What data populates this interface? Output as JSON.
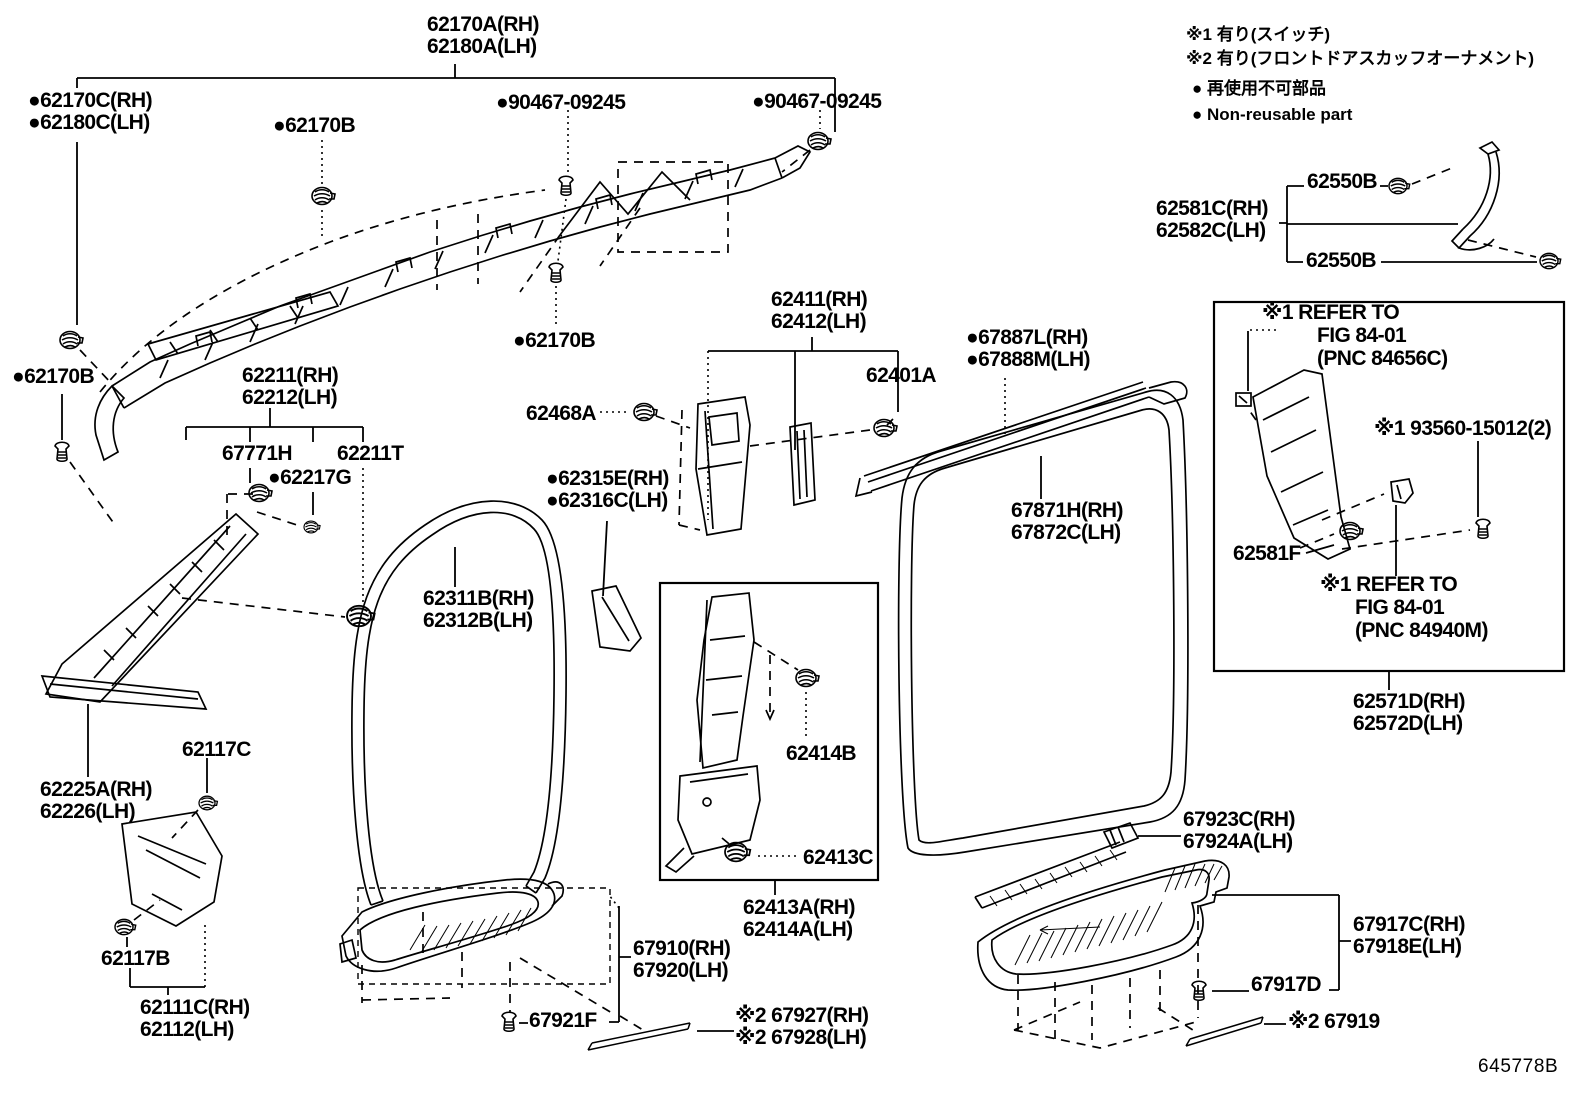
{
  "page": {
    "title": "Toyota interior trim parts diagram - inside trim board, pillar garnish and scuff plates",
    "drawing_number": "645778B",
    "background": "#ffffff",
    "line_color": "#000000"
  },
  "legend": {
    "note1": "※1 有り(スイッチ)",
    "note2": "※2 有り(フロントドアスカッフオーナメント)",
    "note3": "● 再使用不可部品",
    "note4": "● Non-reusable part"
  },
  "labels": [
    {
      "id": "62170a",
      "kind": "part",
      "x": 427,
      "y": 14,
      "text": "62170A(RH)\n62180A(LH)"
    },
    {
      "id": "62170c",
      "kind": "part",
      "x": 28,
      "y": 90,
      "text": "●62170C(RH)\n●62180C(LH)"
    },
    {
      "id": "62170b-top",
      "kind": "part",
      "x": 273,
      "y": 115,
      "text": "●62170B"
    },
    {
      "id": "90467-left",
      "kind": "part",
      "x": 496,
      "y": 92,
      "text": "●90467-09245"
    },
    {
      "id": "90467-right",
      "kind": "part",
      "x": 752,
      "y": 91,
      "text": "●90467-09245"
    },
    {
      "id": "note-switch",
      "kind": "note",
      "x": 1186,
      "y": 22,
      "text": "※1 有り(スイッチ)"
    },
    {
      "id": "note-scuff",
      "kind": "note",
      "x": 1186,
      "y": 46,
      "text": "※2 有り(フロントドアスカッフオーナメント)"
    },
    {
      "id": "note-jp",
      "kind": "note",
      "x": 1192,
      "y": 76,
      "text": "● 再使用不可部品"
    },
    {
      "id": "note-en",
      "kind": "note",
      "x": 1192,
      "y": 102,
      "text": "● Non-reusable part"
    },
    {
      "id": "62550b-top",
      "kind": "part",
      "x": 1307,
      "y": 171,
      "text": "62550B"
    },
    {
      "id": "62581c",
      "kind": "part",
      "x": 1156,
      "y": 198,
      "text": "62581C(RH)\n62582C(LH)"
    },
    {
      "id": "62550b-bottom",
      "kind": "part",
      "x": 1306,
      "y": 250,
      "text": "62550B"
    },
    {
      "id": "62170b-left",
      "kind": "part",
      "x": 12,
      "y": 366,
      "text": "●62170B"
    },
    {
      "id": "62211",
      "kind": "part",
      "x": 242,
      "y": 365,
      "text": "62211(RH)\n62212(LH)"
    },
    {
      "id": "67771h",
      "kind": "part",
      "x": 222,
      "y": 443,
      "text": "67771H"
    },
    {
      "id": "62211t",
      "kind": "part",
      "x": 337,
      "y": 443,
      "text": "62211T"
    },
    {
      "id": "62217g",
      "kind": "part",
      "x": 268,
      "y": 467,
      "text": "●62217G"
    },
    {
      "id": "62468a",
      "kind": "part",
      "x": 526,
      "y": 403,
      "text": "62468A"
    },
    {
      "id": "62411",
      "kind": "part",
      "x": 771,
      "y": 289,
      "text": "62411(RH)\n62412(LH)"
    },
    {
      "id": "62401a",
      "kind": "part",
      "x": 866,
      "y": 365,
      "text": "62401A"
    },
    {
      "id": "62170b-mid",
      "kind": "part",
      "x": 513,
      "y": 330,
      "text": "●62170B"
    },
    {
      "id": "67887l",
      "kind": "part",
      "x": 966,
      "y": 327,
      "text": "●67887L(RH)\n●67888M(LH)"
    },
    {
      "id": "62315e",
      "kind": "part",
      "x": 546,
      "y": 468,
      "text": "●62315E(RH)\n●62316C(LH)"
    },
    {
      "id": "67871h",
      "kind": "part",
      "x": 1011,
      "y": 500,
      "text": "67871H(RH)\n67872C(LH)"
    },
    {
      "id": "62311b",
      "kind": "part",
      "x": 423,
      "y": 588,
      "text": "62311B(RH)\n62312B(LH)"
    },
    {
      "id": "refer1-1",
      "kind": "part",
      "x": 1262,
      "y": 302,
      "text": "※1 REFER TO"
    },
    {
      "id": "refer1-2",
      "kind": "part",
      "x": 1317,
      "y": 325,
      "text": "FIG 84-01"
    },
    {
      "id": "refer1-3",
      "kind": "part",
      "x": 1317,
      "y": 348,
      "text": "(PNC 84656C)"
    },
    {
      "id": "93560",
      "kind": "part",
      "x": 1374,
      "y": 418,
      "text": "※1 93560-15012(2)"
    },
    {
      "id": "62581f",
      "kind": "part",
      "x": 1233,
      "y": 543,
      "text": "62581F"
    },
    {
      "id": "refer2-1",
      "kind": "part",
      "x": 1320,
      "y": 574,
      "text": "※1 REFER TO"
    },
    {
      "id": "refer2-2",
      "kind": "part",
      "x": 1355,
      "y": 597,
      "text": "FIG 84-01"
    },
    {
      "id": "refer2-3",
      "kind": "part",
      "x": 1355,
      "y": 620,
      "text": "(PNC 84940M)"
    },
    {
      "id": "62571d",
      "kind": "part",
      "x": 1353,
      "y": 691,
      "text": "62571D(RH)\n62572D(LH)"
    },
    {
      "id": "62117c",
      "kind": "part",
      "x": 182,
      "y": 739,
      "text": "62117C"
    },
    {
      "id": "62225a",
      "kind": "part",
      "x": 40,
      "y": 779,
      "text": "62225A(RH)\n62226(LH)"
    },
    {
      "id": "62414b",
      "kind": "part",
      "x": 786,
      "y": 743,
      "text": "62414B"
    },
    {
      "id": "62413c",
      "kind": "part",
      "x": 803,
      "y": 847,
      "text": "62413C"
    },
    {
      "id": "67923c",
      "kind": "part",
      "x": 1183,
      "y": 809,
      "text": "67923C(RH)\n67924A(LH)"
    },
    {
      "id": "62117b",
      "kind": "part",
      "x": 101,
      "y": 948,
      "text": "62117B"
    },
    {
      "id": "62111c",
      "kind": "part",
      "x": 140,
      "y": 997,
      "text": "62111C(RH)\n62112(LH)"
    },
    {
      "id": "62413a",
      "kind": "part",
      "x": 743,
      "y": 897,
      "text": "62413A(RH)\n62414A(LH)"
    },
    {
      "id": "67910",
      "kind": "part",
      "x": 633,
      "y": 938,
      "text": "67910(RH)\n67920(LH)"
    },
    {
      "id": "67921f",
      "kind": "part",
      "x": 529,
      "y": 1010,
      "text": "67921F"
    },
    {
      "id": "67927",
      "kind": "part",
      "x": 735,
      "y": 1005,
      "text": "※2 67927(RH)\n※2 67928(LH)"
    },
    {
      "id": "67917c",
      "kind": "part",
      "x": 1353,
      "y": 914,
      "text": "67917C(RH)\n67918E(LH)"
    },
    {
      "id": "67917d",
      "kind": "part",
      "x": 1251,
      "y": 974,
      "text": "67917D"
    },
    {
      "id": "67919",
      "kind": "part",
      "x": 1288,
      "y": 1011,
      "text": "※2 67919"
    }
  ]
}
